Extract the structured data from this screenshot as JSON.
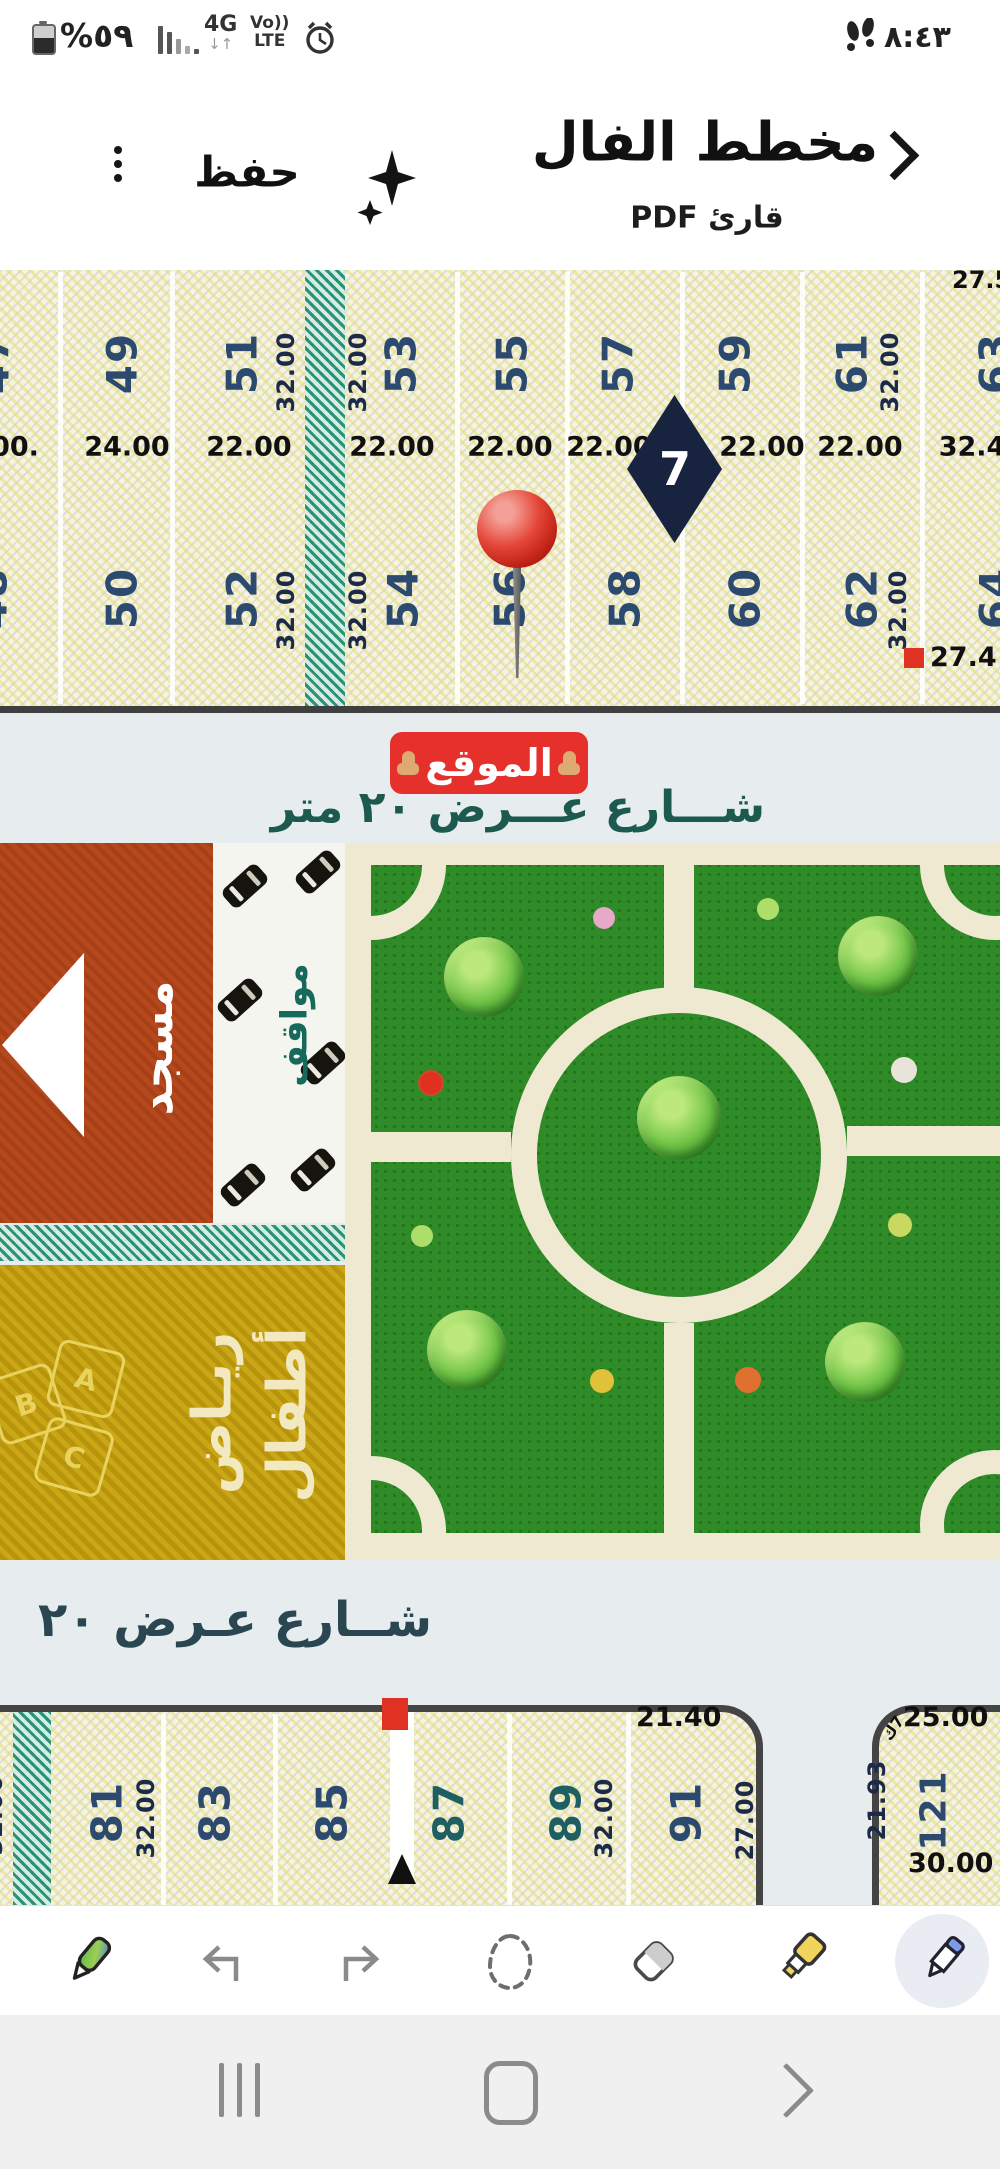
{
  "status_bar": {
    "battery_percent": "%٥٩",
    "network": "4G",
    "network_arrows": "↓↑",
    "volte_line1": "Vo))",
    "volte_line2": "LTE",
    "time": "٨:٤٣"
  },
  "header": {
    "title": "مخطط الفال",
    "subtitle": "قارئ PDF",
    "save_label": "حفظ"
  },
  "plan_top": {
    "row1_plots": [
      "47",
      "49",
      "51",
      "53",
      "55",
      "57",
      "59",
      "61",
      "63"
    ],
    "row1_dim_left": "32.00",
    "row1_dim_right": "32.00",
    "row1_dim_far_right": "32.00",
    "top_right_dim": "27.5",
    "width_dims": [
      ".00",
      "24.00",
      "22.00",
      "22.00",
      "22.00",
      "22.00",
      "22.00",
      "22.00",
      "32.4"
    ],
    "diamond_label": "7",
    "row2_plots": [
      "48",
      "50",
      "52",
      "54",
      "56",
      "58",
      "60",
      "62",
      "64"
    ],
    "row2_dim_left": "32.00",
    "row2_dim_right": "32.00",
    "row2_dim_far_right": "32.00",
    "corner_dim": "27.4"
  },
  "street_top": {
    "location_badge": "الموقع",
    "street_label": "شـــارع عـــرض ٢٠ متر"
  },
  "facilities": {
    "mosque_label": "مسجد",
    "parking_label": "مواقف",
    "kindergarten_label_1": "ريـاض",
    "kindergarten_label_2": "أطفال",
    "block_letters": [
      "A",
      "B",
      "C"
    ]
  },
  "street_bottom": {
    "street_label": "شــارع عـرض ٢٠"
  },
  "plan_bottom": {
    "plots": [
      "81",
      "83",
      "85",
      "87",
      "89",
      "91"
    ],
    "edge_dim": "32.00",
    "dim_81": "32.00",
    "dim_89": "32.00",
    "dim_91": "27.00",
    "dim_top": "21.40",
    "right_block": {
      "dim_top": "25.00",
      "dim_tiny": "7ك",
      "dim_left": "21.93",
      "plot": "121",
      "dim_bottom": "30.00"
    }
  },
  "icons": {
    "back": "chevron-right",
    "menu": "kebab-menu",
    "assist": "sparkles",
    "alarm": "alarm-clock",
    "steps": "footprints",
    "battery": "battery-half",
    "signal": "signal-bars",
    "pin": "map-pin",
    "location_fingers": "pointing-finger",
    "toolbar": [
      "color-pen",
      "undo",
      "redo",
      "lasso-select",
      "eraser",
      "highlighter",
      "active-pen"
    ],
    "nav": [
      "recents",
      "home",
      "back"
    ]
  }
}
